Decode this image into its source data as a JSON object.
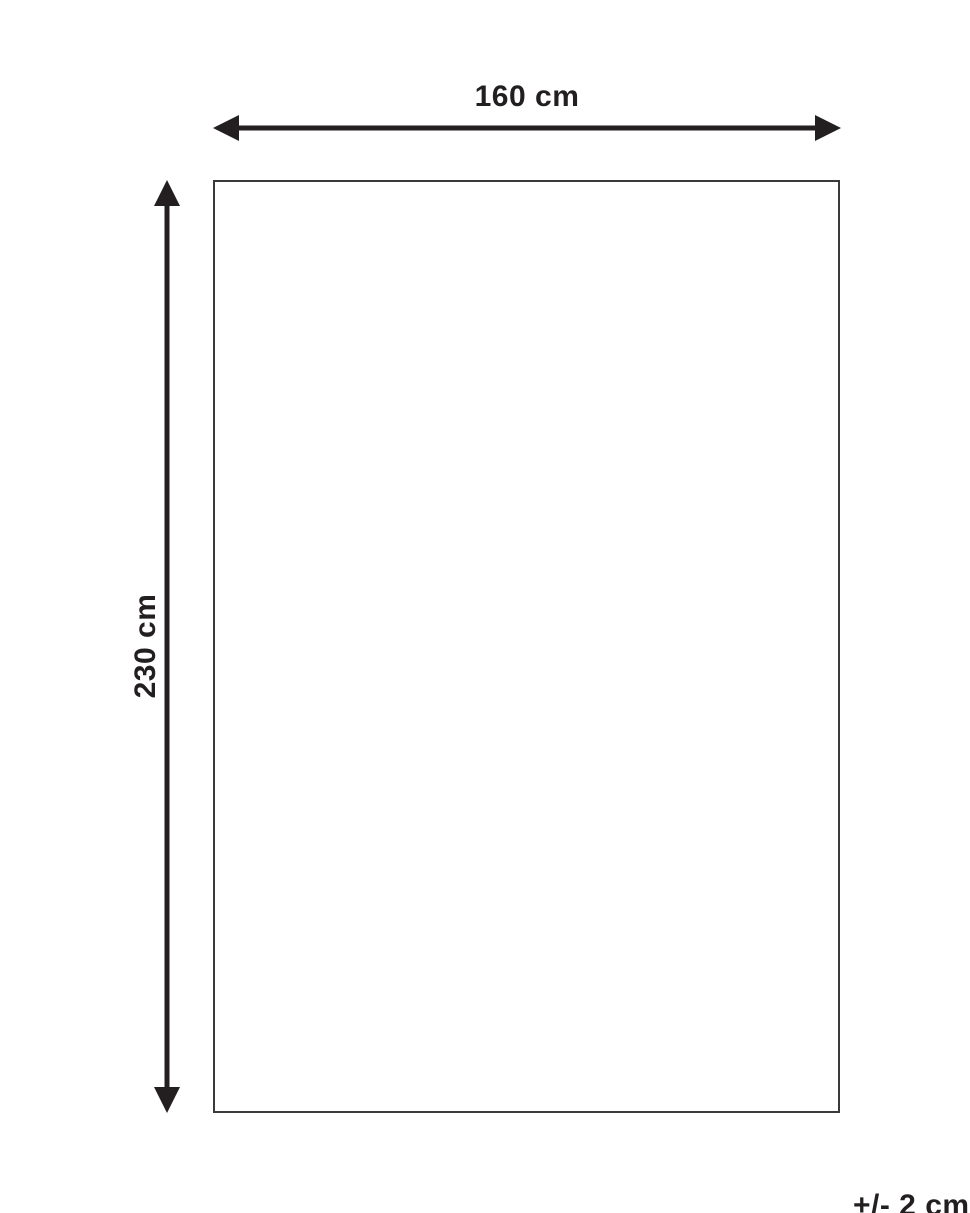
{
  "diagram": {
    "kind": "product-dimension-diagram",
    "width_label": "160 cm",
    "height_label": "230 cm",
    "tolerance_label": "+/- 2 cm",
    "width_value_cm": 160,
    "height_value_cm": 230,
    "tolerance_value_cm": 2,
    "colors": {
      "arrow": "#231f20",
      "outline": "#3a3a3a",
      "text": "#231f20",
      "background": "#ffffff"
    }
  }
}
